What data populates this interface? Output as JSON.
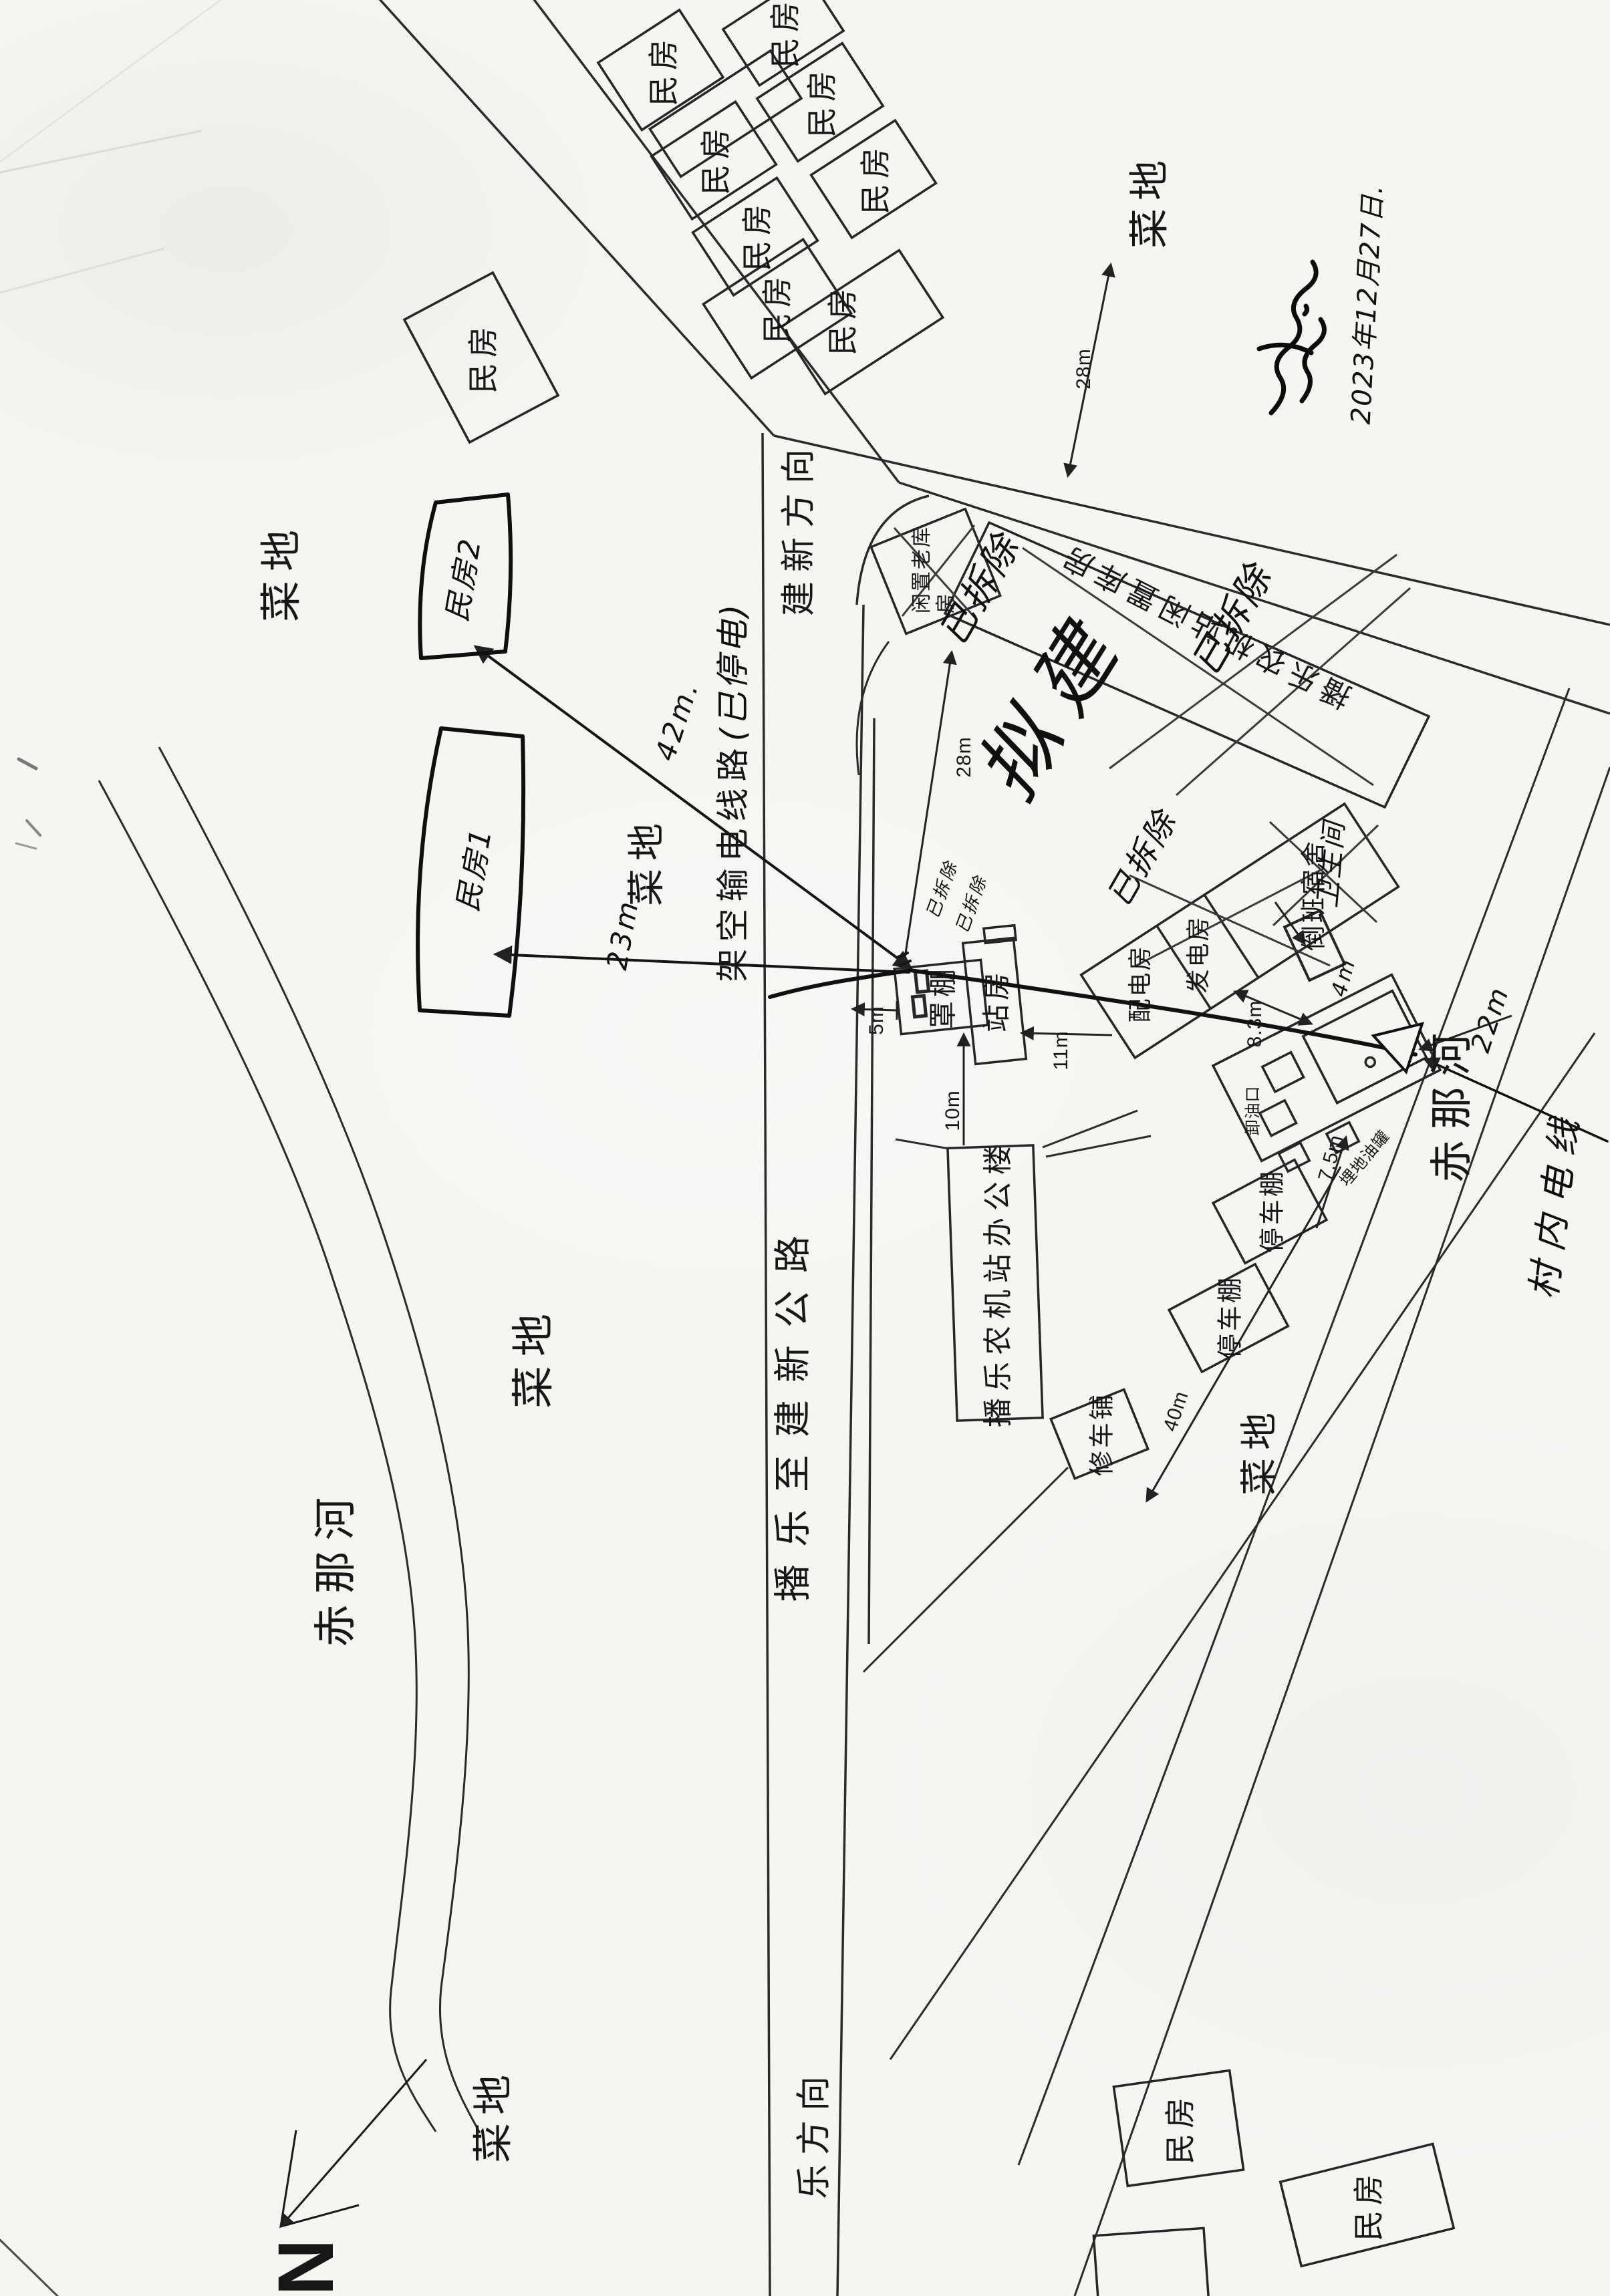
{
  "map": {
    "date_note": "2023年12月27日.",
    "north_symbol": "N",
    "roads": {
      "highway_name": "播乐至建新公路",
      "toward_jianxin": "建新方向",
      "toward_le": "乐方向"
    },
    "rivers": {
      "name": "赤那河"
    },
    "fields": {
      "vegetable_field": "菜地"
    },
    "houses": {
      "residential": "民房",
      "hand_house_1": "民房1",
      "hand_house_2": "民房2"
    },
    "power": {
      "overhead_line": "架空输电线路",
      "line_status": "(已停电)",
      "village_line": "村内电线"
    },
    "station": {
      "canopy": "罩棚",
      "station_house": "站房",
      "office": "播乐农机站办公楼",
      "repair_shop": "修车铺",
      "parking_shed": "停车棚",
      "distribution_room": "配电房",
      "generator_room": "发电房",
      "shift_dorm": "倒班宿舍",
      "idle_old_warehouse_l1": "闲置老库",
      "idle_old_warehouse_l2": "房",
      "station_idle_warehouse": "播乐农机站闲置库房",
      "oil_unloading": "卸油口",
      "buried_tanks": "埋地油罐",
      "toilet": "卫生间"
    },
    "annotations": {
      "demolished": "已拆除",
      "planned": "拟建"
    },
    "dimensions": {
      "d5m": "5m",
      "d10m": "10m",
      "d11m": "11m",
      "d28m": "28m",
      "d8_3m": "8.3m",
      "d7_5m": "7.5m",
      "d40m": "40m",
      "d22m": "22m",
      "d42m": "42m.",
      "d23m": "23m.",
      "d4m": "4m"
    }
  }
}
